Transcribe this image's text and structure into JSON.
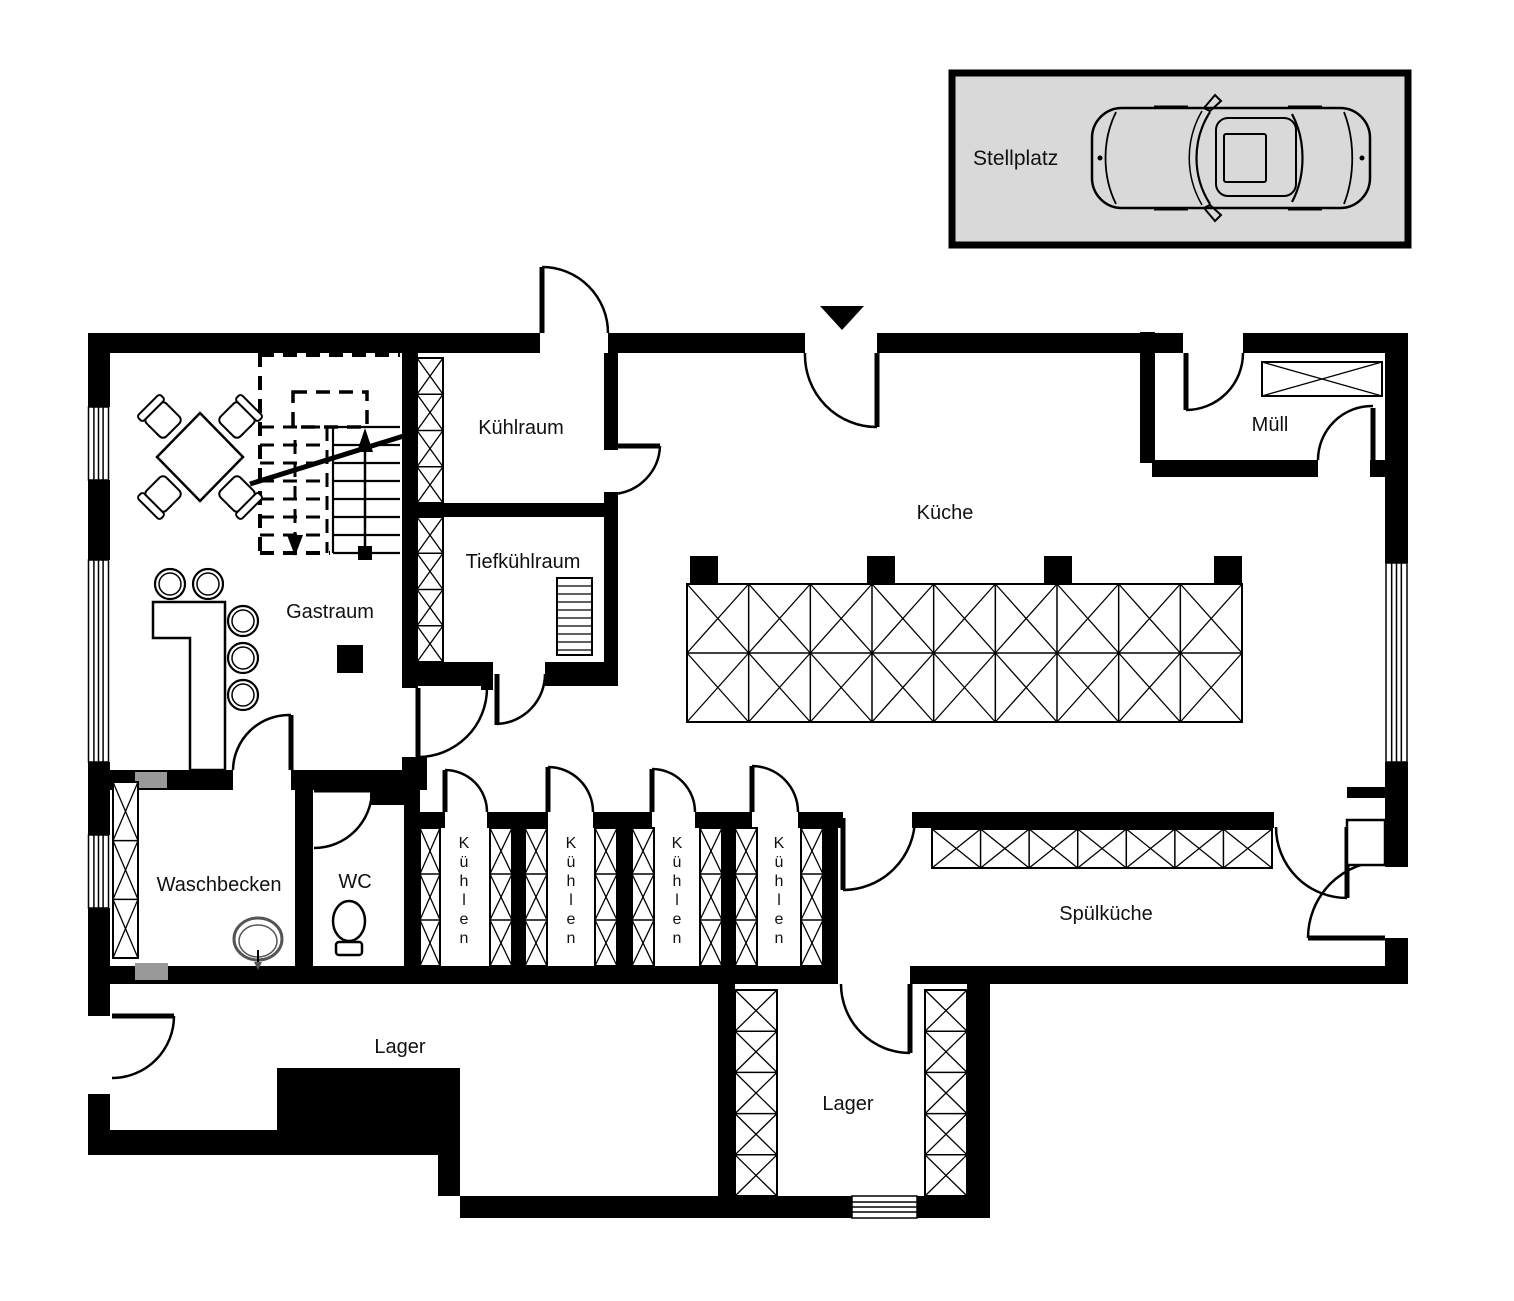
{
  "parking": {
    "label": "Stellplatz"
  },
  "rooms": {
    "kuehlraum": "Kühlraum",
    "tiefkuehlraum": "Tiefkühlraum",
    "gastraum": "Gastraum",
    "kueche": "Küche",
    "muell": "Müll",
    "waschbecken": "Waschbecken",
    "wc": "WC",
    "spuelkueche": "Spülküche",
    "lager_left": "Lager",
    "lager_right": "Lager",
    "cool_cells": [
      "Kühlen",
      "Kühlen",
      "Kühlen",
      "Kühlen"
    ]
  },
  "colors": {
    "wall": "#000000",
    "paper": "#ffffff",
    "parking_fill": "#d9d9d9",
    "hatch_insert": "#999999",
    "text": "#111111"
  }
}
